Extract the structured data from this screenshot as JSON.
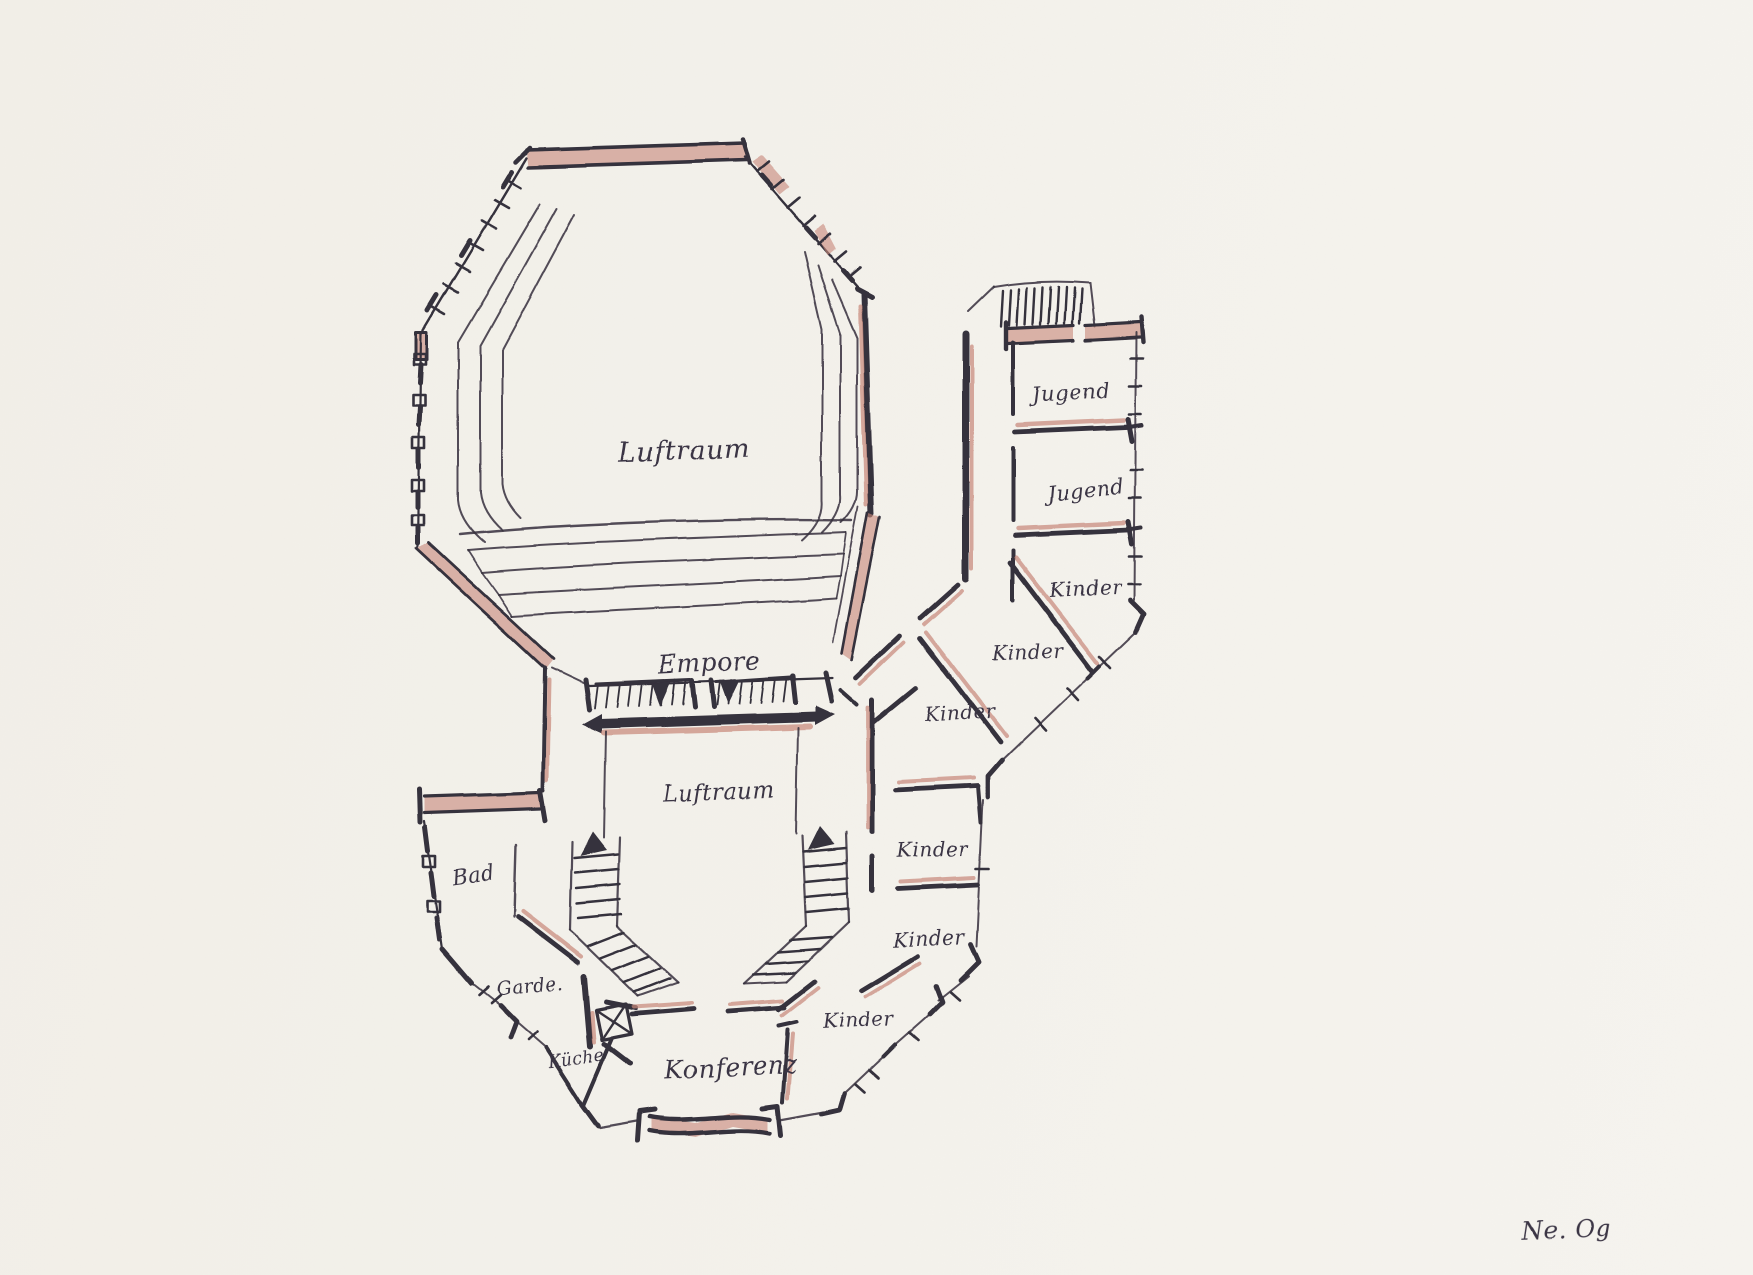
{
  "palette": {
    "paper": "#f2efe8",
    "ink": "#35303c",
    "wall_accent": "#c8897c",
    "text_ink": "#3a3444"
  },
  "labels": {
    "upper_void": "Luftraum",
    "gallery": "Empore",
    "lower_void": "Luftraum",
    "youth_rooms": [
      "Jugend",
      "Jugend"
    ],
    "kids_rooms": [
      "Kinder",
      "Kinder",
      "Kinder",
      "Kinder",
      "Kinder",
      "Kinder"
    ],
    "bath": "Bad",
    "cloakroom": "Garde.",
    "kitchen": "Küche",
    "conference": "Konferenz"
  },
  "annotation": "Ne. Og"
}
